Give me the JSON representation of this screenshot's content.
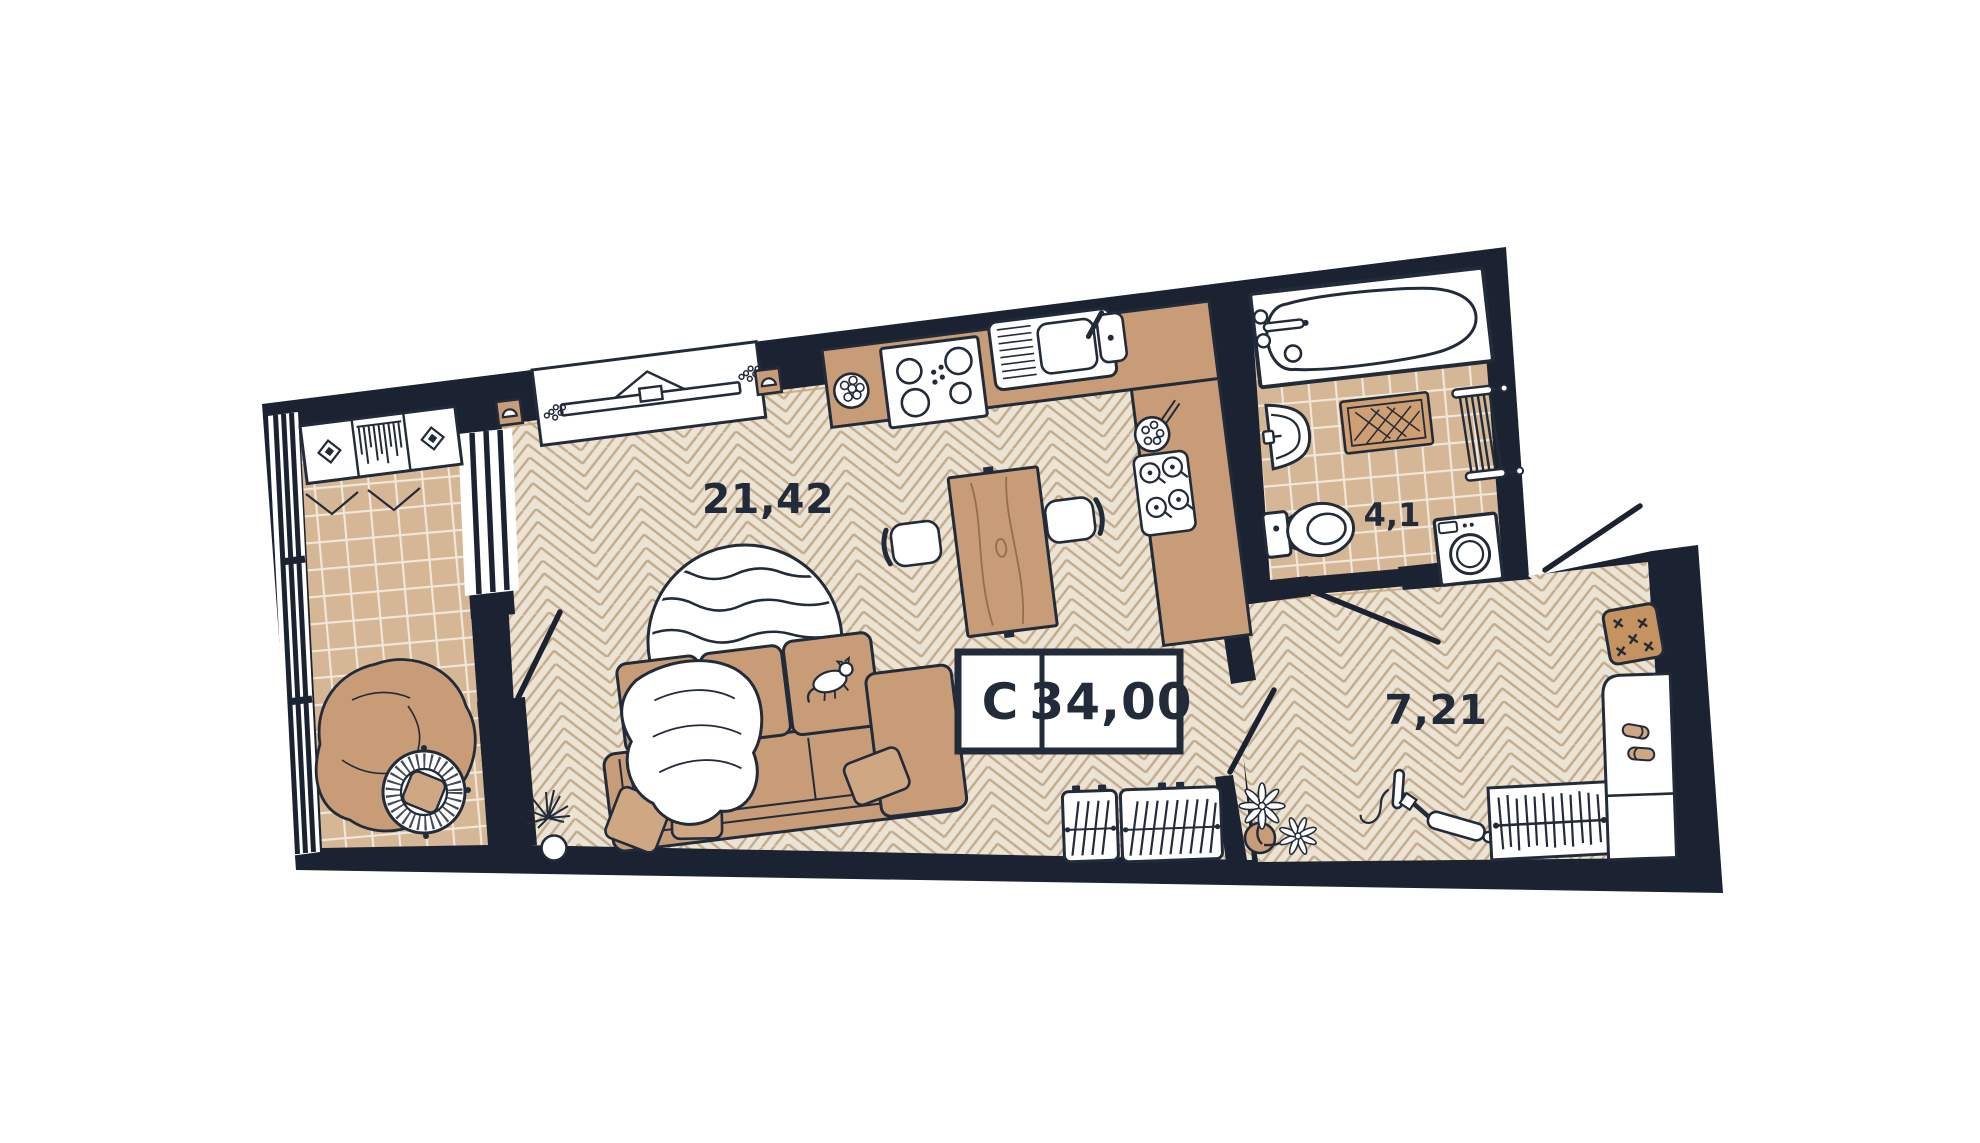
{
  "unit": {
    "type_label": "C",
    "total_area_label": "34,00"
  },
  "rooms": [
    {
      "name": "living-room-kitchen",
      "area_label": "21,42",
      "floor": "herringbone-parquet",
      "fixtures": [
        "tv-console",
        "wall-lamp",
        "wall-lamp",
        "kitchen-counter",
        "cooktop",
        "kitchen-sink",
        "fruit-bowl",
        "food-plate",
        "tea-tray",
        "dining-table",
        "dining-chair",
        "dining-chair",
        "round-rug",
        "sofa",
        "blanket",
        "cat",
        "pillows",
        "plant",
        "shoe-cabinet",
        "shoe-cabinet"
      ]
    },
    {
      "name": "bathroom",
      "area_label": "4,1",
      "floor": "ceramic-tile",
      "fixtures": [
        "bathtub",
        "washbasin",
        "toilet",
        "bath-mat",
        "towel-radiator",
        "washing-machine"
      ]
    },
    {
      "name": "hallway",
      "area_label": "7,21",
      "floor": "herringbone-parquet",
      "fixtures": [
        "doormat",
        "kick-scooter",
        "plant",
        "wardrobe-rail-with-hangers",
        "shoe-bench",
        "slippers"
      ]
    },
    {
      "name": "balcony",
      "floor": "ceramic-tile",
      "fixtures": [
        "wardrobe-folding-doors",
        "bean-bag",
        "papasan-chair",
        "panoramic-window"
      ]
    }
  ],
  "colors": {
    "wall": "#1b2231",
    "ink": "#222b3a",
    "floorwood": "#ebe4d4",
    "woodline": "#c6ab8a",
    "tile": "#d6b795",
    "grout": "#f0e8da",
    "furn": "#c79c76",
    "furnlight": "#cfa883",
    "mat": "#c4935f",
    "wooddark": "#946f4e",
    "trim": "#c8a87e",
    "paper": "#ffffff"
  }
}
